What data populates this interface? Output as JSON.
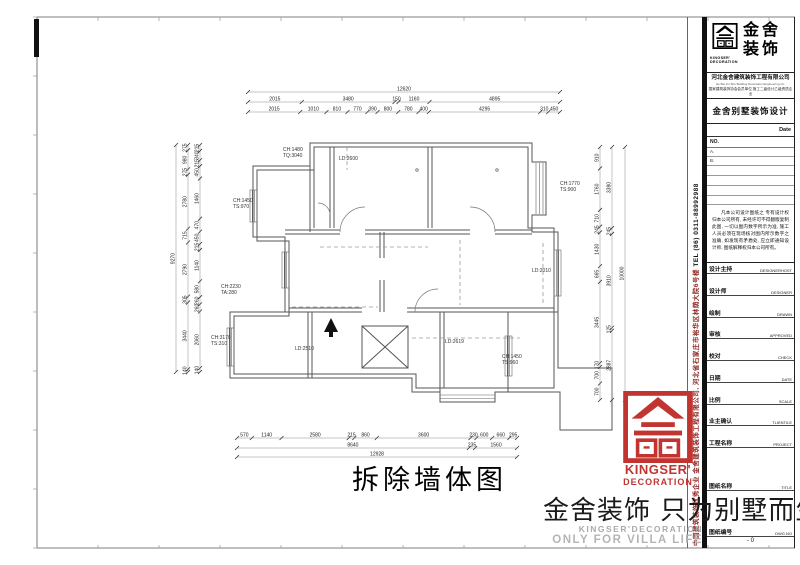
{
  "drawing": {
    "title": "拆除墙体图",
    "labels": [
      {
        "text": "CH:1480\nTQ:3040"
      },
      {
        "text": "LD:2600"
      },
      {
        "text": "CH:1450\nTS:970"
      },
      {
        "text": "CH:2230\nTA:280"
      },
      {
        "text": "CH:3170\nTS:310"
      },
      {
        "text": "LD:2510"
      },
      {
        "text": "LD:2010"
      },
      {
        "text": "CH:1770\nTS:900"
      },
      {
        "text": "LD:2619"
      },
      {
        "text": "CH:1450\nTS:960"
      }
    ]
  },
  "dimensions": {
    "top_overall": "12620",
    "top_row2": [
      "2015",
      "3480",
      "150",
      "1160",
      "4895"
    ],
    "top_row3": [
      "2015",
      "1010",
      "810",
      "770",
      "390",
      "800",
      "780",
      "400",
      "4295",
      "310",
      "450"
    ],
    "bottom_row1": [
      "570",
      "1140",
      "2580",
      "215",
      "860",
      "3600",
      "230",
      "600",
      "660",
      "295"
    ],
    "bottom_row2": [
      "8640",
      "235",
      "1560"
    ],
    "bottom_overall": "12928",
    "left_outer": "9270",
    "left_mid": [
      "275",
      "980",
      "275",
      "2780",
      "715",
      "2790",
      "305",
      "3440",
      "140"
    ],
    "left_inner": [
      "215",
      "340",
      "215",
      "450",
      "1460",
      "470",
      "450",
      "215",
      "1140",
      "580",
      "260",
      "260",
      "2060",
      "140"
    ],
    "right_inner": [
      "910",
      "1760",
      "710",
      "245",
      "1430",
      "665",
      "3445",
      "170",
      "700",
      "700"
    ],
    "right_mid": [
      "3380",
      "245",
      "3910",
      "125",
      "2887"
    ],
    "right_outer": "10000"
  },
  "title_block": {
    "brand": {
      "zh1": "金舍",
      "zh2": "装饰",
      "en1": "KINGSER'",
      "en2": "DECORATION"
    },
    "company": {
      "name_zh": "河北金舍建筑装饰工程有限公司",
      "name_en": "He Bei Jin She Building Decoration Engineering Co.",
      "note": "国家建筑装饰协会会员单位 施工二级设计乙级资质企业"
    },
    "project_title": "金舍别墅装饰设计",
    "date_label": "Date",
    "no_label": "NO.",
    "revs": [
      "A.",
      "B."
    ],
    "notice": "凡本公司设计图纸之 专有设计权归本公司所有, 未经许可不得翻版复制此图, 一切以图内数字所示为准, 施工人员必须在现场核对图内所示数字之准确, 如发现有矛盾处, 应立即通知设计师, 图纸解释权归本公司所有。",
    "fields": [
      {
        "zh": "设计主持",
        "en": "DESIGNERHOST"
      },
      {
        "zh": "设计师",
        "en": "DESIGNER"
      },
      {
        "zh": "绘制",
        "en": "DRAWN"
      },
      {
        "zh": "审核",
        "en": "APPROVED"
      },
      {
        "zh": "校对",
        "en": "CHECK"
      },
      {
        "zh": "日期",
        "en": "DATE"
      },
      {
        "zh": "比例",
        "en": "SCALE"
      },
      {
        "zh": "业主确认",
        "en": "TLIENTILE"
      },
      {
        "zh": "工程名称",
        "en": "PROJECT"
      },
      {
        "zh": "图纸名称",
        "en": "TITLE"
      },
      {
        "zh": "图纸编号",
        "en": "DWG.NO"
      }
    ],
    "sheet_no": "- 0"
  },
  "side_strip": {
    "company": "中国建筑装饰优秀企业 金舍建筑装饰工程有限公司, 河北省石家庄市裕华区林荫大院6号楼",
    "tel": "TEL (86) 0311-88992988"
  },
  "watermark": {
    "en1": "KINGSER'",
    "en2": "DECORATION",
    "slogan": "金舍装饰 只为别墅而生。",
    "sub1": "KINGSER'DECORATION",
    "sub2": "ONLY FOR VILLA LIFE",
    "red": "#c23430"
  }
}
